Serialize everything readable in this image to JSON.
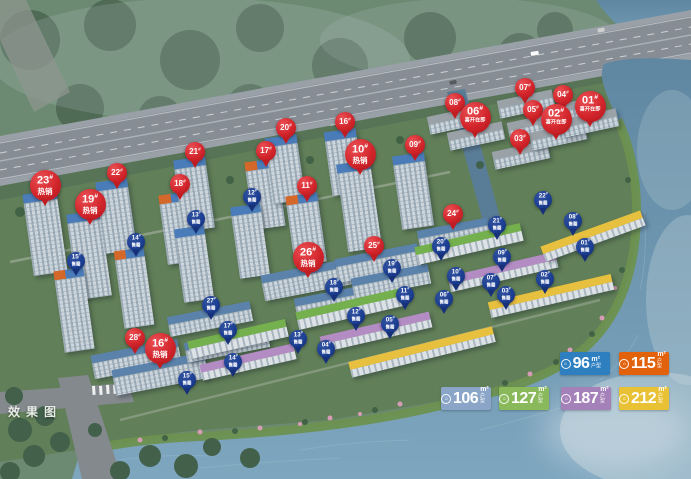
{
  "watermark": {
    "text": "效果图"
  },
  "legend": {
    "unit": "m²",
    "type_label": "户型",
    "icon": "house-icon",
    "rows": [
      [
        {
          "area": "96",
          "color": "#2e7fc0"
        },
        {
          "area": "115",
          "color": "#e2620c"
        }
      ],
      [
        {
          "area": "106",
          "color": "#8aa5c8"
        },
        {
          "area": "127",
          "color": "#8ab95c"
        },
        {
          "area": "187",
          "color": "#a581b9"
        },
        {
          "area": "212",
          "color": "#e9c134"
        }
      ]
    ]
  },
  "badges": {
    "number_suffix": "#",
    "status_labels": {
      "hot": "热销",
      "opening": "喜开在即",
      "sold": "售罄"
    },
    "colors": {
      "on_sale": "#d2252b",
      "sold_out": "#1c3f94"
    },
    "items": [
      {
        "n": "23",
        "s": "hot",
        "x": 45,
        "y": 185
      },
      {
        "n": "19",
        "s": "hot",
        "x": 90,
        "y": 204
      },
      {
        "n": "10",
        "s": "hot",
        "x": 360,
        "y": 154
      },
      {
        "n": "26",
        "s": "hot",
        "x": 308,
        "y": 257
      },
      {
        "n": "16",
        "s": "hot",
        "x": 160,
        "y": 348
      },
      {
        "n": "06",
        "s": "opening",
        "x": 475,
        "y": 117
      },
      {
        "n": "02",
        "s": "opening",
        "x": 556,
        "y": 119
      },
      {
        "n": "01",
        "s": "opening",
        "x": 590,
        "y": 106
      },
      {
        "n": "22",
        "s": "none",
        "x": 117,
        "y": 173
      },
      {
        "n": "21",
        "s": "none",
        "x": 195,
        "y": 152
      },
      {
        "n": "20",
        "s": "none",
        "x": 286,
        "y": 128
      },
      {
        "n": "18",
        "s": "none",
        "x": 180,
        "y": 184
      },
      {
        "n": "17",
        "s": "none",
        "x": 266,
        "y": 151
      },
      {
        "n": "16",
        "s": "none",
        "x": 345,
        "y": 122
      },
      {
        "n": "11",
        "s": "none",
        "x": 307,
        "y": 186
      },
      {
        "n": "09",
        "s": "none",
        "x": 415,
        "y": 145
      },
      {
        "n": "28",
        "s": "none",
        "x": 135,
        "y": 338
      },
      {
        "n": "25",
        "s": "none",
        "x": 374,
        "y": 246
      },
      {
        "n": "24",
        "s": "none",
        "x": 453,
        "y": 214
      },
      {
        "n": "08",
        "s": "none",
        "x": 455,
        "y": 103
      },
      {
        "n": "07",
        "s": "none",
        "x": 525,
        "y": 88
      },
      {
        "n": "05",
        "s": "none",
        "x": 533,
        "y": 110
      },
      {
        "n": "04",
        "s": "none",
        "x": 563,
        "y": 95
      },
      {
        "n": "03",
        "s": "none",
        "x": 520,
        "y": 139
      },
      {
        "n": "15",
        "s": "sold",
        "x": 76,
        "y": 261
      },
      {
        "n": "14",
        "s": "sold",
        "x": 136,
        "y": 242
      },
      {
        "n": "13",
        "s": "sold",
        "x": 196,
        "y": 219
      },
      {
        "n": "12",
        "s": "sold",
        "x": 252,
        "y": 197
      },
      {
        "n": "27",
        "s": "sold",
        "x": 211,
        "y": 305
      },
      {
        "n": "17",
        "s": "sold",
        "x": 228,
        "y": 330
      },
      {
        "n": "15",
        "s": "sold",
        "x": 187,
        "y": 380
      },
      {
        "n": "14",
        "s": "sold",
        "x": 233,
        "y": 362
      },
      {
        "n": "18",
        "s": "sold",
        "x": 334,
        "y": 287
      },
      {
        "n": "13",
        "s": "sold",
        "x": 298,
        "y": 339
      },
      {
        "n": "12",
        "s": "sold",
        "x": 356,
        "y": 316
      },
      {
        "n": "04",
        "s": "sold",
        "x": 326,
        "y": 349
      },
      {
        "n": "05",
        "s": "sold",
        "x": 390,
        "y": 324
      },
      {
        "n": "19",
        "s": "sold",
        "x": 392,
        "y": 268
      },
      {
        "n": "11",
        "s": "sold",
        "x": 405,
        "y": 295
      },
      {
        "n": "20",
        "s": "sold",
        "x": 441,
        "y": 246
      },
      {
        "n": "10",
        "s": "sold",
        "x": 456,
        "y": 276
      },
      {
        "n": "06",
        "s": "sold",
        "x": 444,
        "y": 299
      },
      {
        "n": "21",
        "s": "sold",
        "x": 497,
        "y": 225
      },
      {
        "n": "09",
        "s": "sold",
        "x": 502,
        "y": 257
      },
      {
        "n": "07",
        "s": "sold",
        "x": 491,
        "y": 282
      },
      {
        "n": "03",
        "s": "sold",
        "x": 506,
        "y": 295
      },
      {
        "n": "02",
        "s": "sold",
        "x": 545,
        "y": 279
      },
      {
        "n": "22",
        "s": "sold",
        "x": 543,
        "y": 200
      },
      {
        "n": "08",
        "s": "sold",
        "x": 573,
        "y": 221
      },
      {
        "n": "01",
        "s": "sold",
        "x": 585,
        "y": 247
      }
    ]
  }
}
